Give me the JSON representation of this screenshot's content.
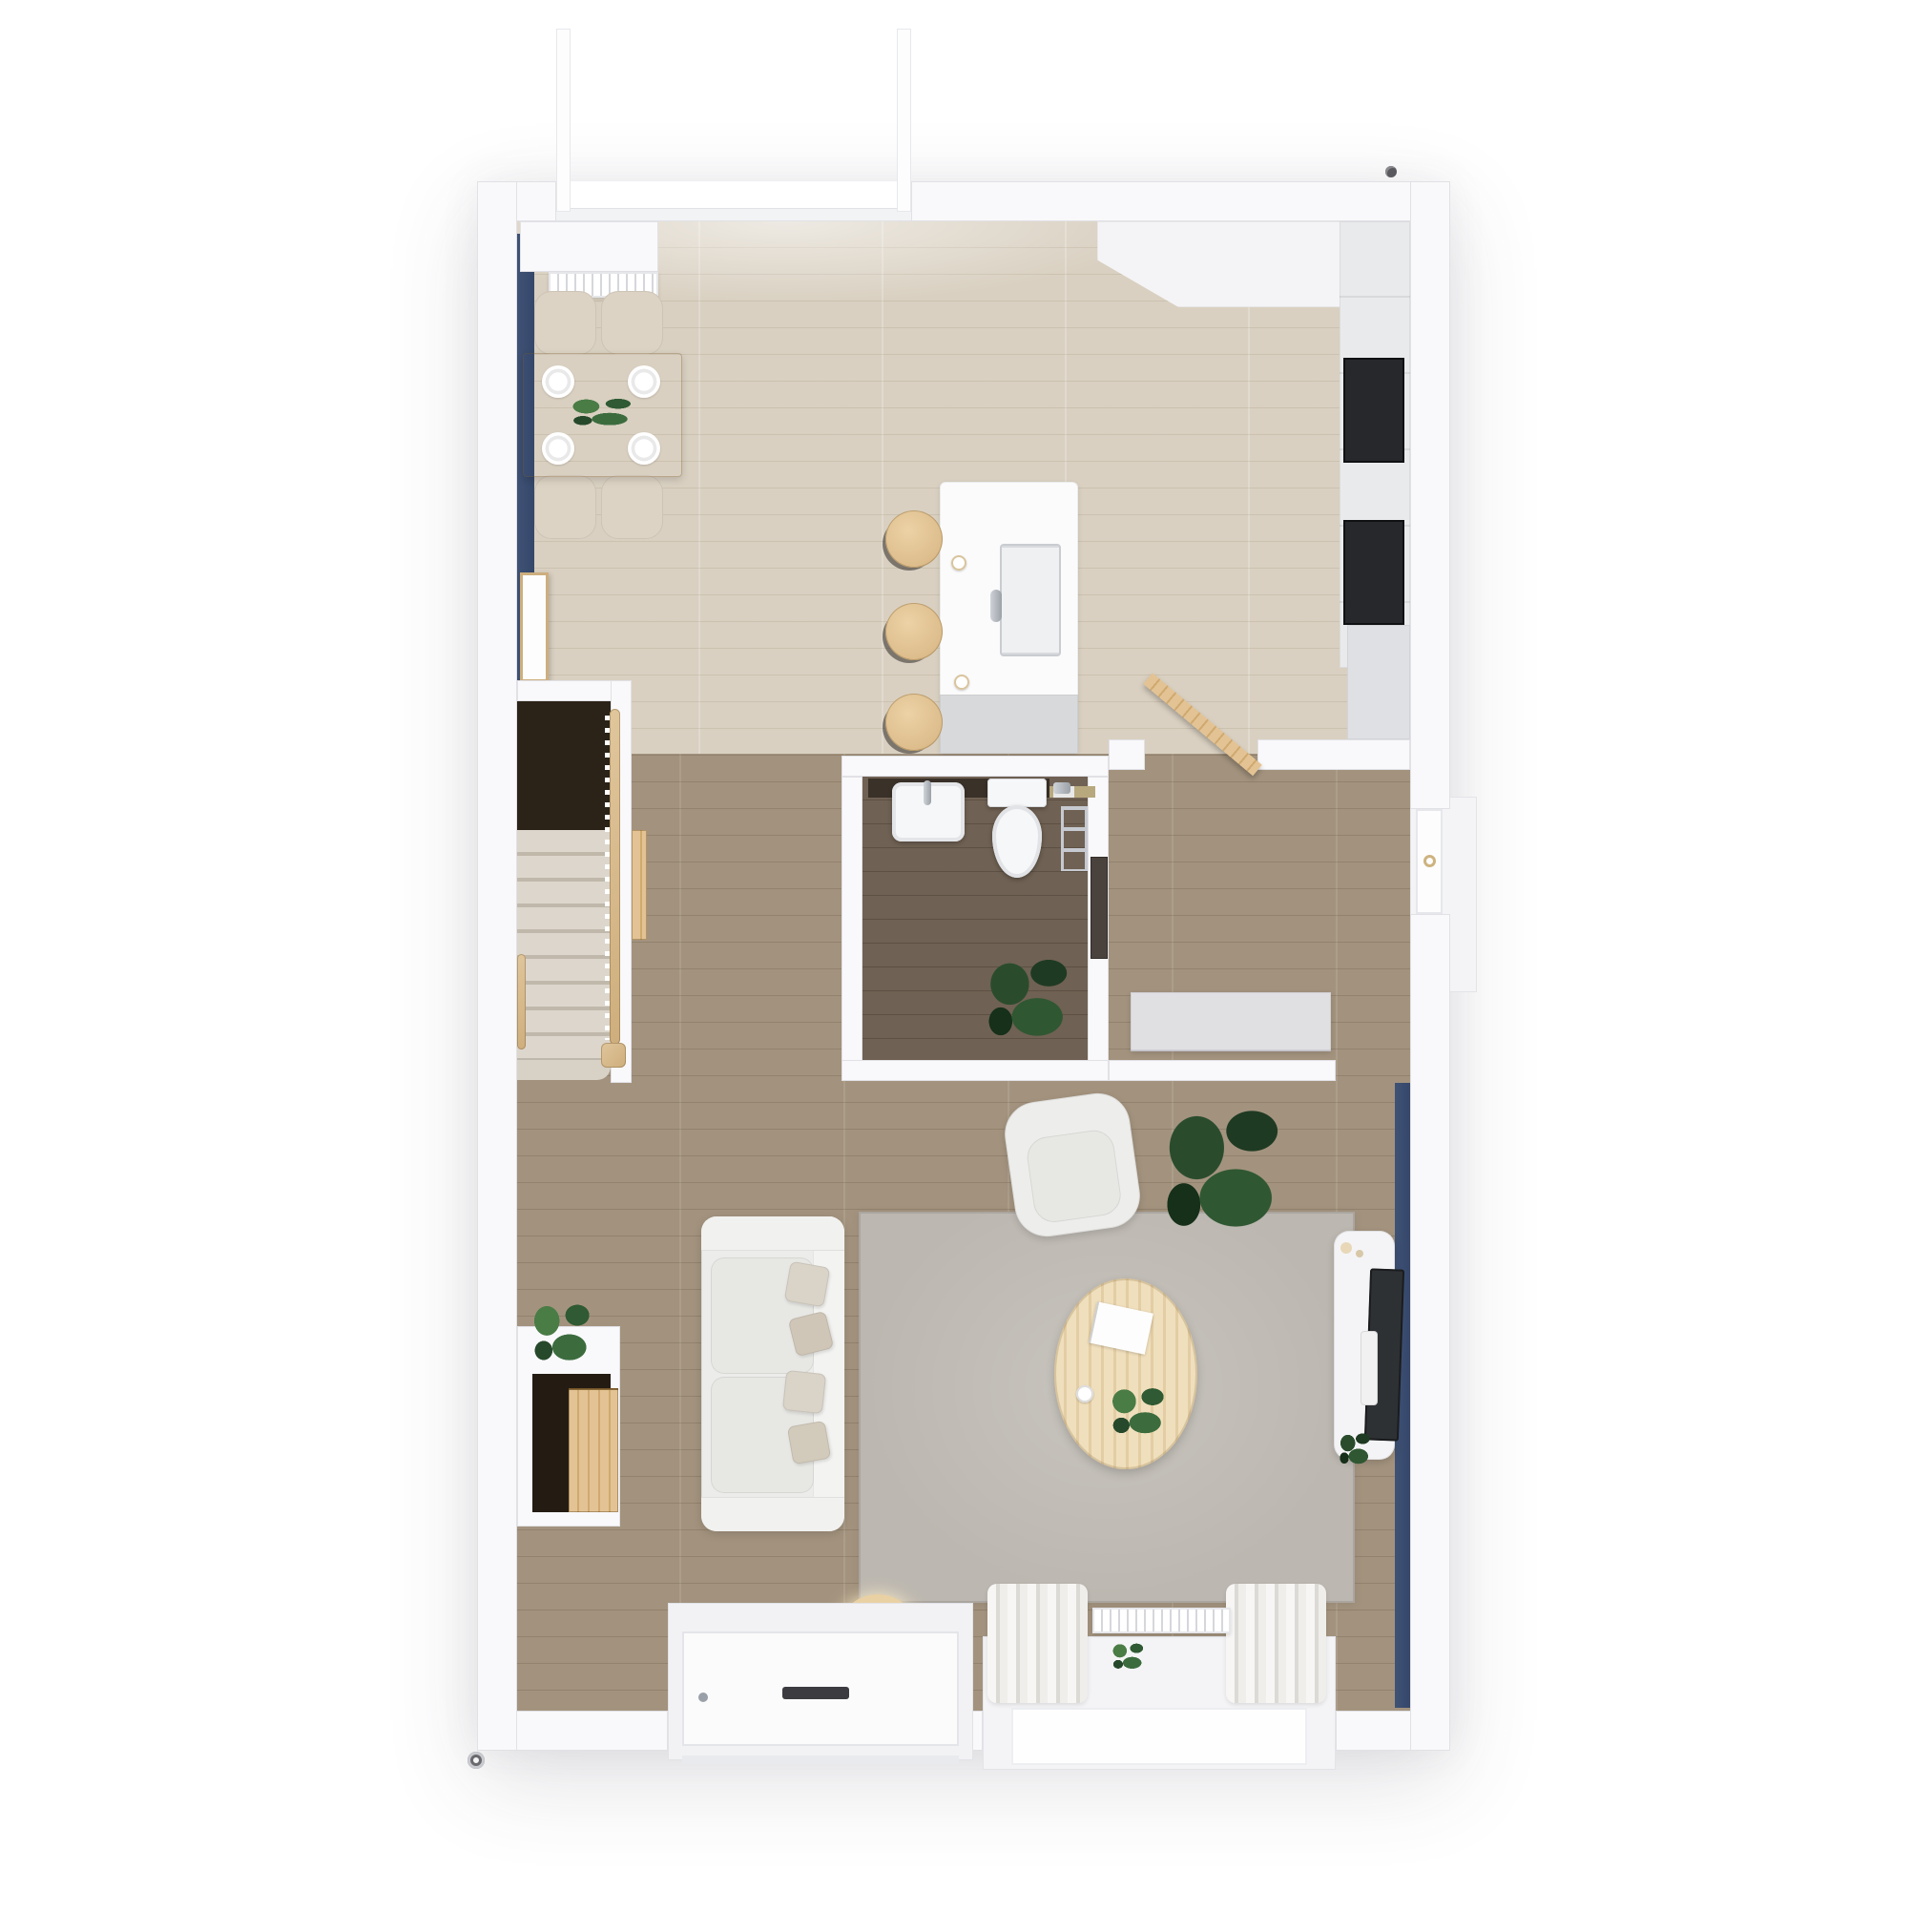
{
  "meta": {
    "kind": "3d-rendered-floor-plan",
    "view": "top-down-dollhouse",
    "text_visible": false
  },
  "palette": {
    "background": "#ffffff",
    "wall": "#f9f9fb",
    "wall_line": "#e1e1e6",
    "floor_kitchen_dining": "#d9d0c1",
    "floor_hall_living": "#a3937e",
    "floor_wc": "#6f6153",
    "accent_blue_wall": "#3f5275",
    "wood_door_rail": "#dcb888",
    "wood_table": "#d6c3a4",
    "counter_white": "#fafafb",
    "counter_gray": "#d8d9db",
    "appliance_black": "#26282b",
    "sofa_fabric": "#ececea",
    "rug_gray": "#bcb7b0",
    "coffee_table_wood": "#eddcb8",
    "plant_green": "#35603a",
    "plant_dark_green": "#24452a",
    "curtain_white": "#f4f3f1",
    "css_style": "--bg:#ffffff;--wall:#f9f9fb;--wall-line:#e1e1e6;--floor-k:#d9d0c1;--floor-h:#a3937e;--floor-wc:#6f6153;--blue:#3f5275;--wood:#dcb888;--cwhite:#fafafb;--cgray:#d8d9db;--black:#26282b;--sofa:#ececea;--rug:#bcb7b0;--ctable:#eddcb8;--green:#35603a;--curtain:#f4f3f1"
  },
  "labels": {
    "building": "ground-floor-plan",
    "kitchen_dining": "kitchen-dining-area",
    "hallway": "hallway",
    "wc": "cloakroom-wc",
    "staircase": "staircase",
    "entrance": "entrance-hall",
    "living": "living-room",
    "bay_window": "bay-window",
    "front_door": "front-door",
    "patio_doors": "patio-doors-open"
  },
  "rooms": [
    {
      "id": "kitchen-dining",
      "floor": "light-oak-planks"
    },
    {
      "id": "hallway",
      "floor": "oak-planks"
    },
    {
      "id": "cloakroom-wc",
      "floor": "dark-oak-planks"
    },
    {
      "id": "staircase",
      "floor": "beige-carpet-treads"
    },
    {
      "id": "entrance-hall",
      "floor": "oak-planks"
    },
    {
      "id": "living-room",
      "floor": "oak-planks"
    }
  ],
  "fixtures": {
    "kitchen_dining": [
      "wall-radiator",
      "dining-table",
      "dining-chair-1",
      "dining-chair-2",
      "dining-chair-3",
      "dining-chair-4",
      "place-setting-x4",
      "table-plants",
      "leaning-wall-frame",
      "blue-accent-wall",
      "kitchen-island",
      "island-sink",
      "island-faucet",
      "coffee-cup-x2",
      "bar-stool-1",
      "bar-stool-2",
      "bar-stool-3",
      "corner-counter",
      "counter-run",
      "built-in-oven",
      "black-cooktop",
      "tall-cabinet",
      "patio-door-leaf-x2"
    ],
    "cloakroom_wc": [
      "vanity-shelf",
      "wash-basin",
      "toilet",
      "toilet-roll-holder",
      "towel-rail",
      "foliage-plant",
      "wc-door"
    ],
    "hallway_entrance": [
      "open-wood-door",
      "storage-bench",
      "entrance-porch",
      "entrance-door",
      "door-wreath"
    ],
    "staircase": [
      "carpet-treads",
      "dark-landing",
      "wood-handrail",
      "baluster-row",
      "newel-post",
      "under-stair-door",
      "wall-handrail"
    ],
    "living_room": [
      "sofa",
      "seat-cushion-x2",
      "pillow-x4",
      "armchair",
      "monstera-plant",
      "area-rug",
      "oval-coffee-table",
      "magazine",
      "table-plant",
      "coffee-cup",
      "tv-sideboard",
      "leaning-tv",
      "soundbar",
      "tv-plant",
      "floor-lamp-hoop",
      "curtain-left",
      "curtain-right",
      "window-radiator",
      "sill-plant",
      "bay-window",
      "blue-accent-wall",
      "under-stair-console",
      "console-plant",
      "console-cabinet",
      "front-door",
      "letterbox"
    ],
    "exterior": [
      "corner-door-pin",
      "drain-pipe",
      "porch-step"
    ]
  }
}
